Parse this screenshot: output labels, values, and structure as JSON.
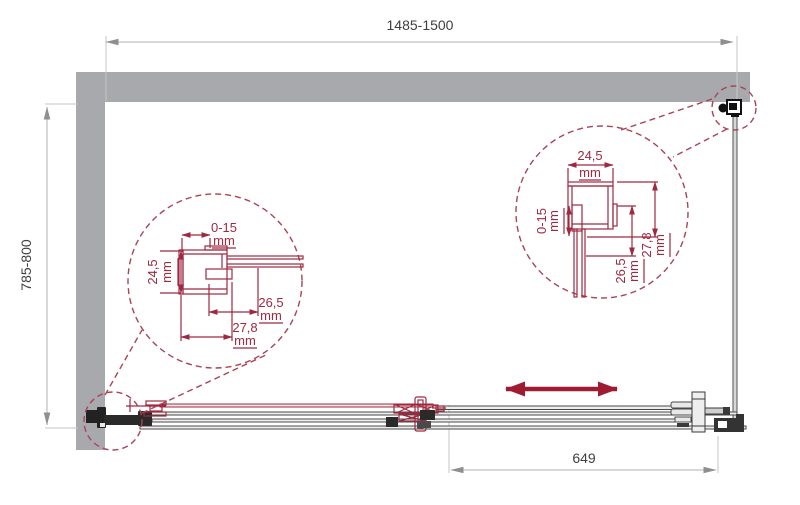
{
  "drawing": {
    "dimensions": {
      "overall_width": "1485-1500",
      "overall_depth": "785-800",
      "door_travel": "649"
    },
    "unit": "mm",
    "detail_left": {
      "top": "0-15",
      "left": "24,5",
      "right": "26,5",
      "bottom": "27,8"
    },
    "detail_right": {
      "top": "24,5",
      "left": "0-15",
      "middle": "26,5",
      "right": "27,8"
    },
    "colors": {
      "wall_gray": "#a7a9ac",
      "drawing_red": "#9e2940",
      "arrow_red": "#9e1b32",
      "line_dark": "#3a3a3a",
      "dim_gray": "#b0b0b0",
      "dim_text": "#3f3f3f"
    }
  }
}
